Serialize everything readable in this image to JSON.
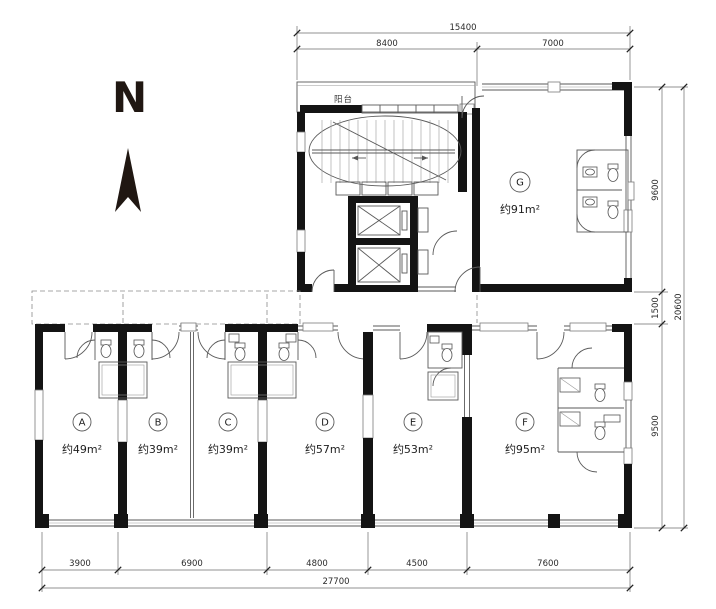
{
  "north": {
    "label": "N"
  },
  "balcony": {
    "label": "阳台"
  },
  "rooms": [
    {
      "id": "A",
      "area": "约49m²"
    },
    {
      "id": "B",
      "area": "约39m²"
    },
    {
      "id": "C",
      "area": "约39m²"
    },
    {
      "id": "D",
      "area": "约57m²"
    },
    {
      "id": "E",
      "area": "约53m²"
    },
    {
      "id": "F",
      "area": "约95m²"
    },
    {
      "id": "G",
      "area": "约91m²"
    }
  ],
  "dimensions": {
    "top": {
      "total": "15400",
      "segments": [
        "8400",
        "7000"
      ]
    },
    "bottom": {
      "total": "27700",
      "segments": [
        "3900",
        "6900",
        "4800",
        "4500",
        "7600"
      ]
    },
    "right": {
      "total": "20600",
      "segments": [
        "9600",
        "1500",
        "9500"
      ]
    }
  },
  "colors": {
    "wall": "#141414",
    "line": "#5a5a5a",
    "text": "#2a2a2a",
    "background": "#ffffff"
  }
}
